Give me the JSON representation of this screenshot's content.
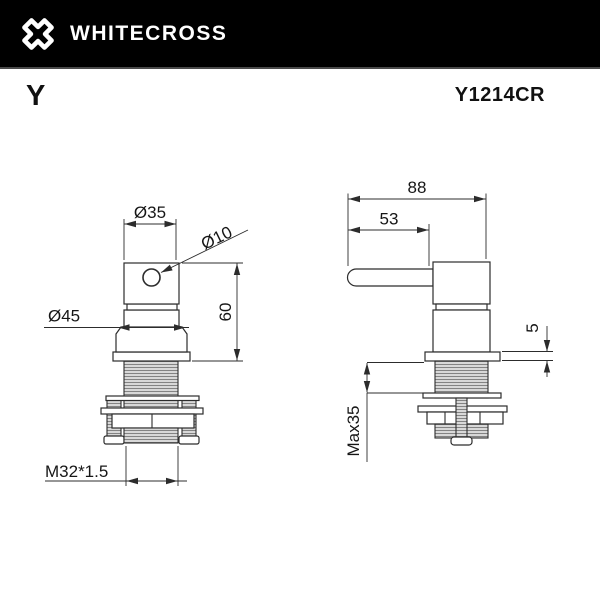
{
  "header": {
    "brand": "WHITECROSS",
    "logo_icon": "whitecross-x-icon"
  },
  "title_row": {
    "series": "Y",
    "model": "Y1214CR"
  },
  "dims": {
    "front": {
      "top_diameter": "Ø35",
      "hole_diameter": "Ø10",
      "collar_diameter": "Ø45",
      "body_height": "60",
      "thread_spec": "M32*1.5"
    },
    "side": {
      "overall_width": "88",
      "handle_length": "53",
      "flange_height": "5",
      "max_mounting": "Max35"
    }
  },
  "colors": {
    "header_bg": "#000000",
    "brand_text": "#ffffff",
    "line": "#2c2c2c",
    "thread_fill": "#d8d8d8",
    "thread_stripe": "#838383",
    "background": "#ffffff"
  }
}
